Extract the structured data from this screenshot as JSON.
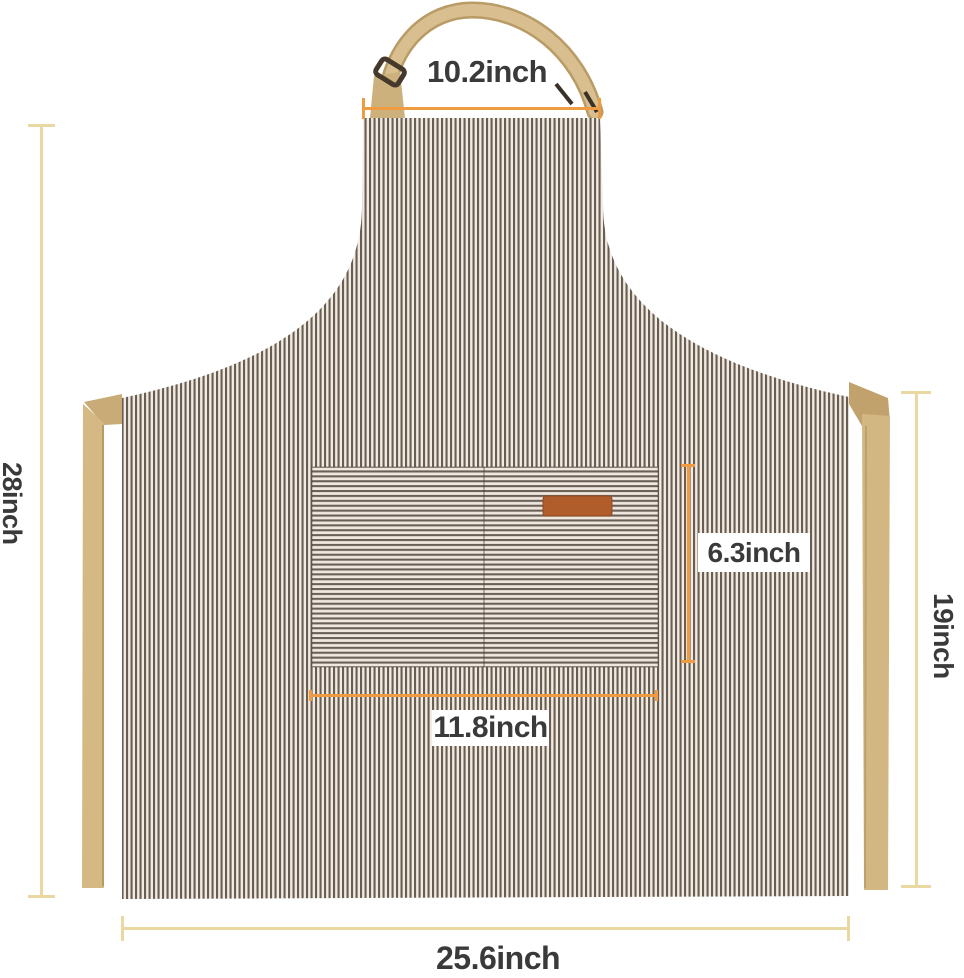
{
  "image": {
    "type": "product dimension diagram",
    "product": "striped bib apron with front pocket, khaki neck strap and waist ties"
  },
  "measurements": {
    "neck_strap_width": "10.2inch",
    "total_height": "28inch",
    "pocket_height": "6.3inch",
    "pocket_width": "11.8inch",
    "skirt_height": "19inch",
    "bottom_width": "25.6inch"
  },
  "colors": {
    "background": "#ffffff",
    "text": "#3a3a3a",
    "stripe_dark": "#695e54",
    "stripe_light": "#f1ebe2",
    "pocket_stripe_dark": "#6b6057",
    "pocket_stripe_light": "#efe8df",
    "strap_khaki": "#d5ba87",
    "strap_khaki_dark": "#b99b66",
    "label_patch": "#b05c2b",
    "dimension_orange": "#ee9b42",
    "dimension_cream": "#e9d8a2",
    "label_box": "#ffffff"
  }
}
